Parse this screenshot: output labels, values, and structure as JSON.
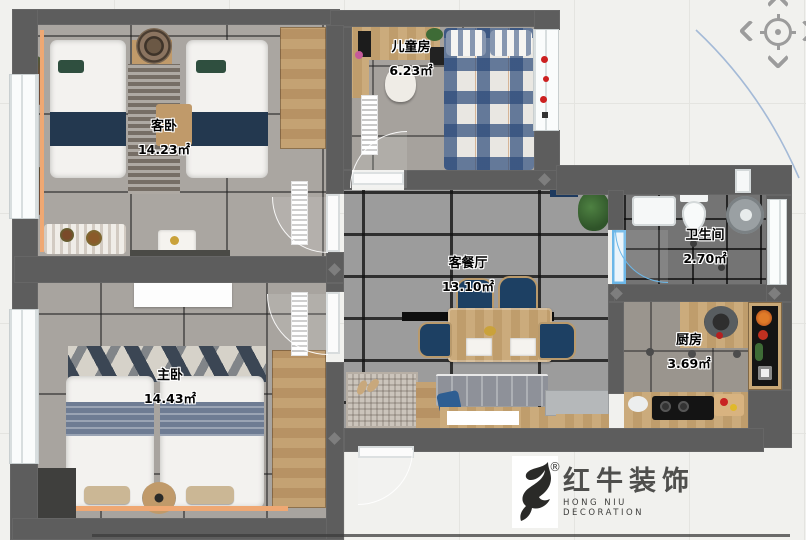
{
  "app": {
    "background": "#f1f1ee",
    "grid_color": "#e4e4e0"
  },
  "pan_control": {
    "icons": [
      "chevron-up-icon",
      "chevron-left-icon",
      "crosshair-target-icon",
      "chevron-right-icon",
      "chevron-down-icon"
    ]
  },
  "rooms": [
    {
      "name": "guest-bedroom",
      "label": "客卧",
      "area": "14.23㎡"
    },
    {
      "name": "children-room",
      "label": "儿童房",
      "area": "6.23㎡"
    },
    {
      "name": "living-dining",
      "label": "客餐厅",
      "area": "13.10㎡"
    },
    {
      "name": "bathroom",
      "label": "卫生间",
      "area": "2.70㎡"
    },
    {
      "name": "kitchen",
      "label": "厨房",
      "area": "3.69㎡"
    },
    {
      "name": "master-bedroom",
      "label": "主卧",
      "area": "14.43㎡"
    }
  ],
  "logo": {
    "registered_mark": "®",
    "title_cn": "红牛装饰",
    "title_en": "HONG NIU DECORATION"
  },
  "colors": {
    "wall": "#5d5d5d",
    "tile_floor": "#9c9c9c",
    "accent_navy": "#1d4063",
    "wood": "#c5a172",
    "curtain_orange": "#efa873",
    "door_blue": "#6cb7e8",
    "arc_blue": "#8aa7cf",
    "pan_icon_gray": "#9c9c9c"
  }
}
